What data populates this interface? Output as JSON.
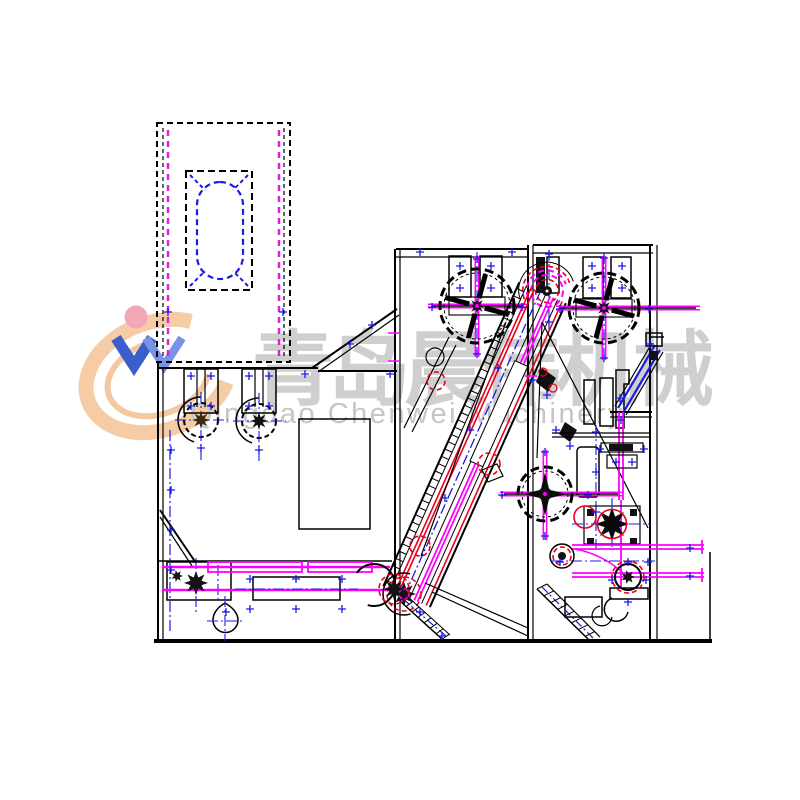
{
  "watermark": {
    "chinese_text": "青岛晨伟机械",
    "latin_text": "Qingdao Chenwei Machinery",
    "chinese_color": "#a8a8a8",
    "latin_color": "#c6c6c6"
  },
  "logo": {
    "name": "chenwei-swoosh-logo",
    "swoosh_color": "#f2bd8d",
    "mark_color_dark": "#2a52c8",
    "mark_color_light": "#6d89e4",
    "dot_color": "#f2a0ae"
  },
  "drawing": {
    "line_colors": {
      "outline_black": "#000000",
      "centerline_blue": "#1a1ae6",
      "accent_magenta": "#ff00ff",
      "accent_red": "#e8001c",
      "chute_magenta": "#e020e0"
    },
    "components": [
      {
        "name": "feed-chute"
      },
      {
        "name": "condenser-drum"
      },
      {
        "name": "feed-roller-left"
      },
      {
        "name": "feed-roller-right"
      },
      {
        "name": "inspection-panel"
      },
      {
        "name": "apron-conveyor"
      },
      {
        "name": "tension-weight"
      },
      {
        "name": "drive-sprocket"
      },
      {
        "name": "inclined-lattice-conveyor"
      },
      {
        "name": "handwheel-middle"
      },
      {
        "name": "handwheel-right"
      },
      {
        "name": "handwheel-front"
      },
      {
        "name": "stripper-drum"
      },
      {
        "name": "gear-cluster"
      },
      {
        "name": "output-shaft"
      },
      {
        "name": "support-frame"
      }
    ]
  }
}
